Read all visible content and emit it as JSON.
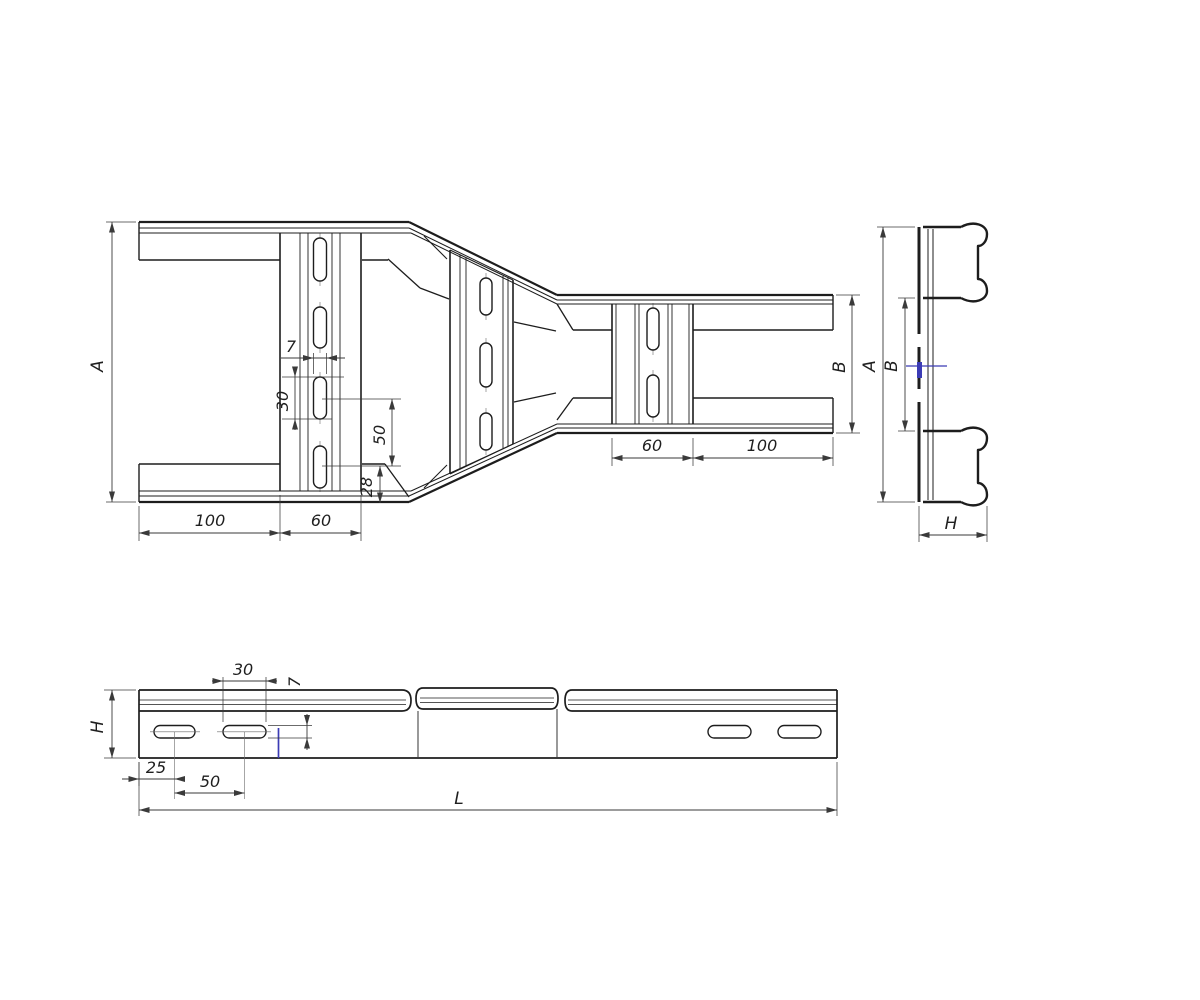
{
  "colors": {
    "background": "#ffffff",
    "line": "#1d1d1d",
    "dimension_line": "#3a3a3a",
    "accent_blue": "#3b3bb5"
  },
  "plan_view": {
    "dim_a": "A",
    "dim_b": "B",
    "dim_100_left": "100",
    "dim_60_left": "60",
    "dim_60_right": "60",
    "dim_100_right": "100",
    "dim_slot_width": "7",
    "dim_slot_length": "30",
    "dim_slot_pitch": "50",
    "dim_edge_offset": "28"
  },
  "end_view": {
    "dim_a": "A",
    "dim_b": "B",
    "dim_h": "H"
  },
  "side_view": {
    "dim_h": "H",
    "dim_length": "L",
    "dim_25": "25",
    "dim_50": "50",
    "dim_30": "30",
    "dim_7": "7"
  }
}
